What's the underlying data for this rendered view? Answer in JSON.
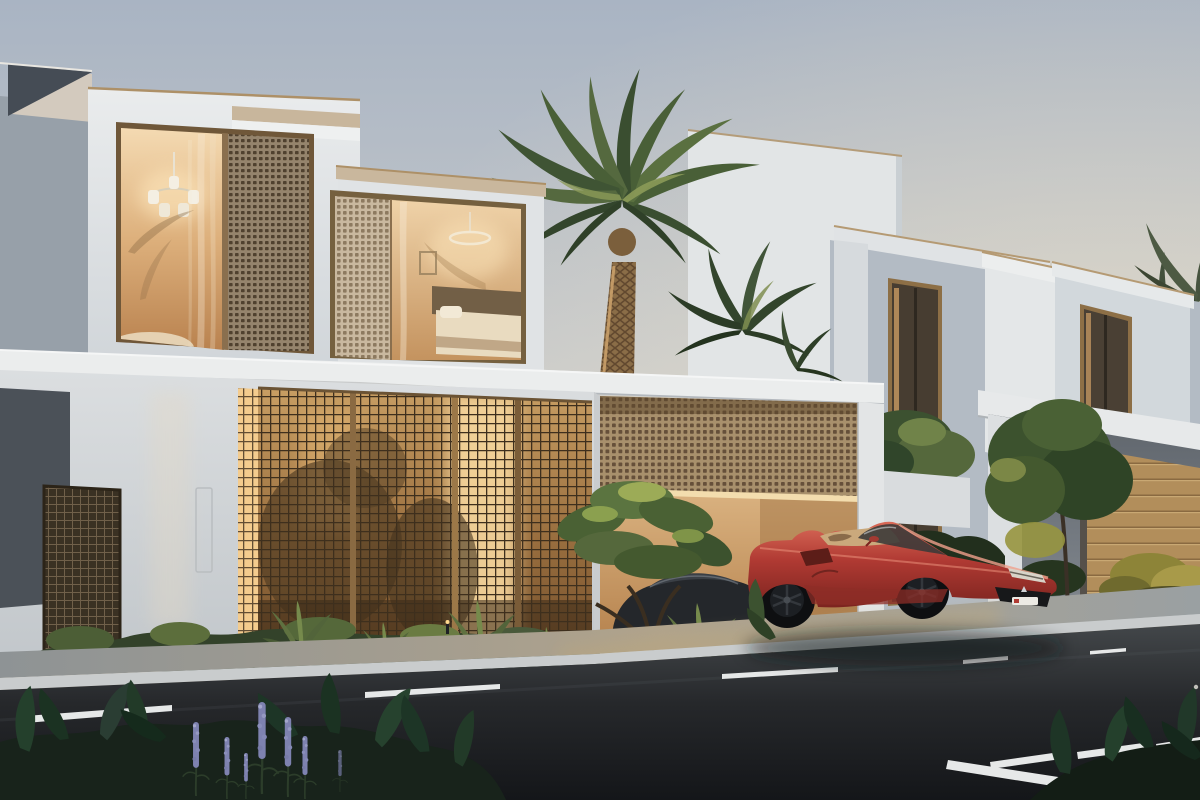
{
  "scene": {
    "description": "Photorealistic dusk rendering of two modern flat-roofed luxury villas with bronze perforated lattice screens, warm-lit interiors with chandelier and pendant lights, an open garage containing a dark sports car, a date palm and lush landscaping, and a red convertible supercar with a trident badge parked on the street beside a dark asphalt road with white dashed lane markings and purple lupine flowers in the foreground",
    "time_of_day": "dusk",
    "objects": [
      {
        "name": "villa-left",
        "label": "two-storey white villa with bronze mesh window screens"
      },
      {
        "name": "villa-right",
        "label": "second white villa with tall tinted windows"
      },
      {
        "name": "garage-left",
        "label": "open garage with perforated bronze shutter and parked dark car"
      },
      {
        "name": "garage-right",
        "label": "closed bronze garage door"
      },
      {
        "name": "red-sports-car",
        "label": "red convertible supercar with tan interior and trident badge"
      },
      {
        "name": "palm-tree",
        "label": "uplit date palm"
      },
      {
        "name": "lattice-screen",
        "label": "backlit bronze lattice privacy screen"
      },
      {
        "name": "road",
        "label": "asphalt road with white dashed lane markings"
      },
      {
        "name": "foreground-planting",
        "label": "dark shrubs with purple lupine flower spikes"
      }
    ]
  },
  "palette": {
    "sky_top": "#a9b4c3",
    "sky_horizon": "#eee2cb",
    "facade_light": "#e8eaeb",
    "facade_shadow": "#97a0a9",
    "facade_dark_panel": "#4b5158",
    "bronze_frame": "#8a6f4e",
    "coping_tan": "#c8b69c",
    "lattice_glow": "#f4d096",
    "interior_warm": "#ddb07c",
    "garage_glow": "#ecc793",
    "mesh_bronze": "#94836c",
    "car_red": "#c04a43",
    "car_red_dark": "#7c241f",
    "car_highlight": "#e98f7a",
    "cockpit_tan": "#caa97c",
    "wheel_black": "#17181a",
    "road": "#202225",
    "road_marking": "#e6e8e8",
    "sidewalk": "#a7aaab",
    "curb": "#c9cccd",
    "foliage_dark": "#17231a",
    "foliage_light": "#6b8347",
    "golden_shrub": "#a89a49",
    "flower_purple": "#8286b4",
    "trunk_bronze": "#8a6d47"
  }
}
